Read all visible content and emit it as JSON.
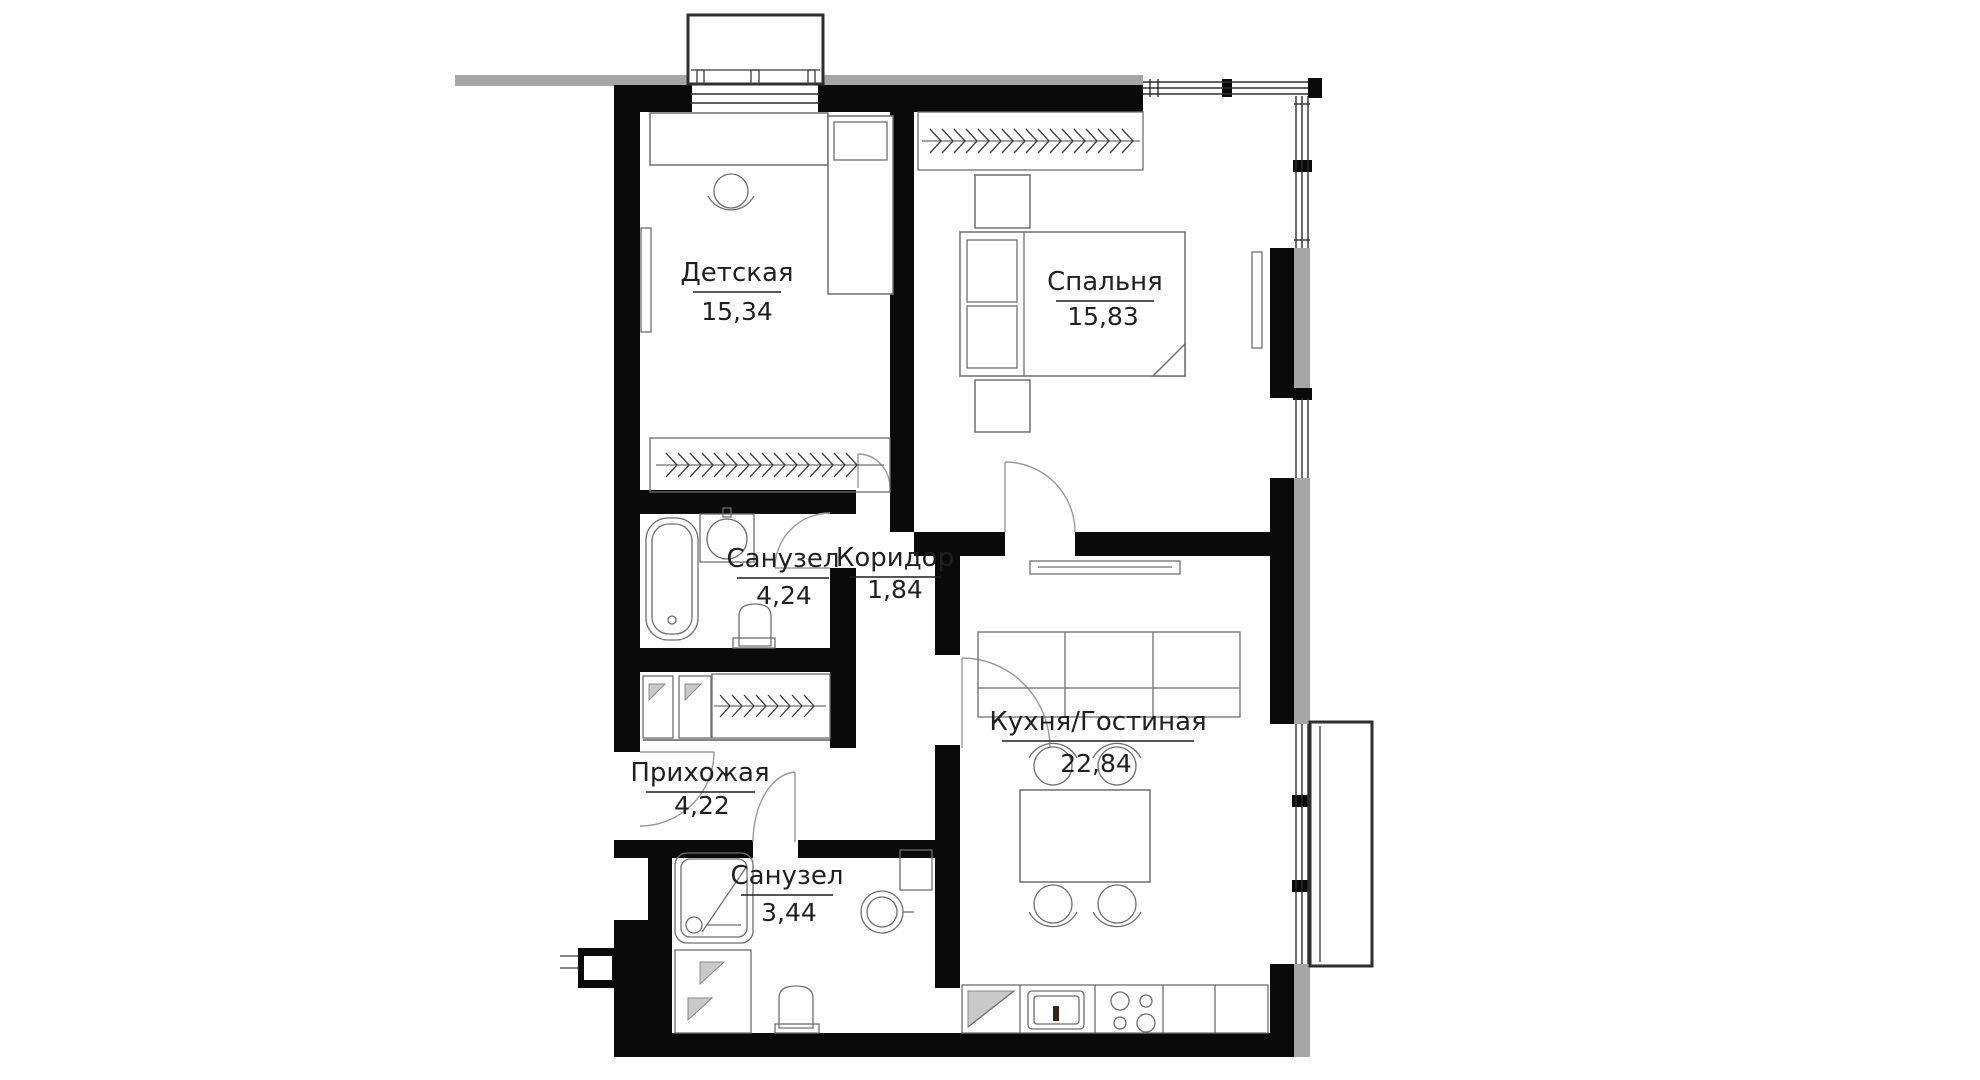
{
  "plan_title": "2-room apartment floor plan",
  "rooms": [
    {
      "name": "Детская",
      "area": "15,34"
    },
    {
      "name": "Спальня",
      "area": "15,83"
    },
    {
      "name": "Санузел",
      "area": "4,24"
    },
    {
      "name": "Коридор",
      "area": "1,84"
    },
    {
      "name": "Кухня/Гостиная",
      "area": "22,84"
    },
    {
      "name": "Прихожая",
      "area": "4,22"
    },
    {
      "name": "Санузел",
      "area": "3,44"
    }
  ],
  "colors": {
    "wall": "#0a0a0a",
    "facade_strip": "#a6a6a6",
    "furniture_line": "#6e6e6e",
    "door_arc": "#9a9a9a",
    "window_line": "#2e2e2e",
    "label_text": "#1f1f1f",
    "background": "#ffffff"
  }
}
